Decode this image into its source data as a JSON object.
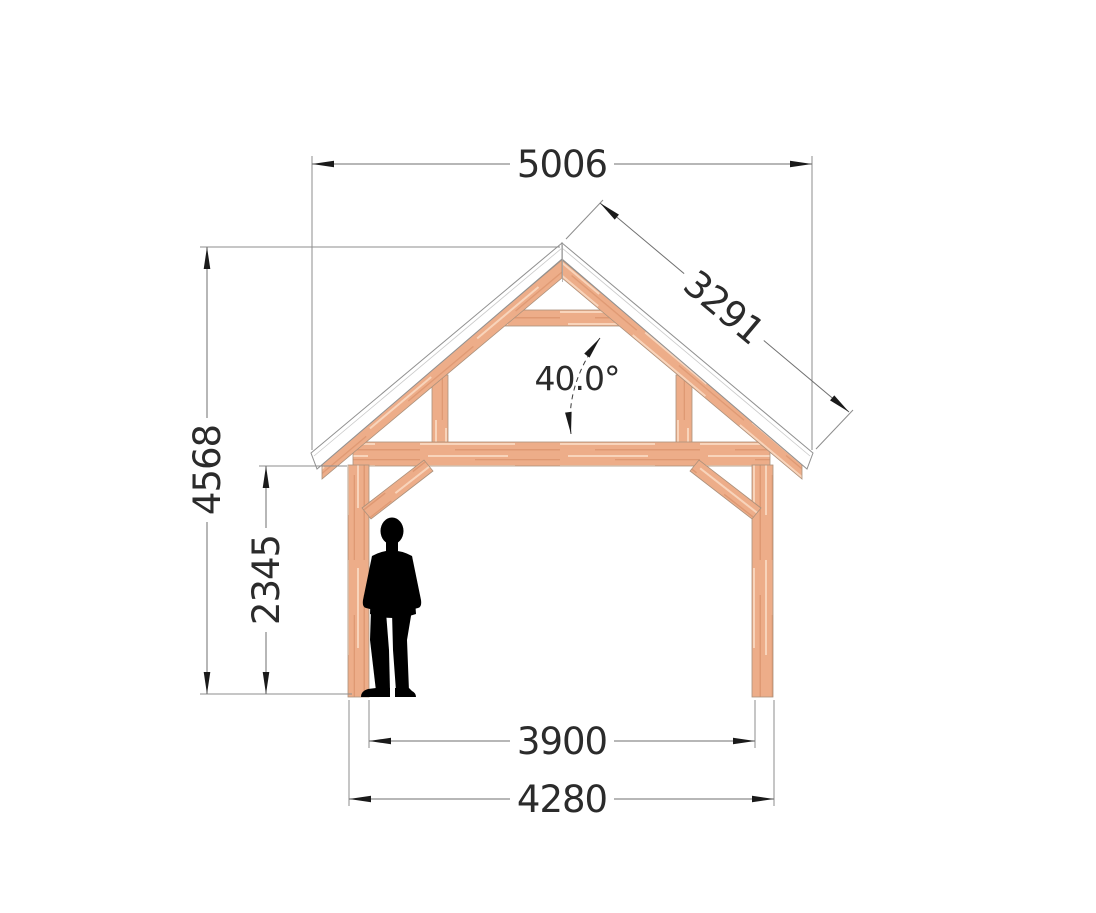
{
  "diagram": {
    "type": "timber-frame-front-elevation",
    "dimensions": {
      "roof_overall_width": "5006",
      "roof_slope_length": "3291",
      "roof_pitch_angle": "40.0°",
      "overall_height": "4568",
      "clearance_height": "2345",
      "posts_inner_span": "3900",
      "posts_outer_span": "4280"
    },
    "colors": {
      "wood": "#edad89",
      "wood_outline": "#ab917c",
      "roof_fill": "#ffffff",
      "roof_outline": "#909090",
      "dim_line": "#6f6f6f",
      "ext_line": "#8d8d8d",
      "arrow": "#1a1a1a",
      "text": "#2b2b2b",
      "figure": "#000000",
      "background": "#ffffff"
    }
  }
}
